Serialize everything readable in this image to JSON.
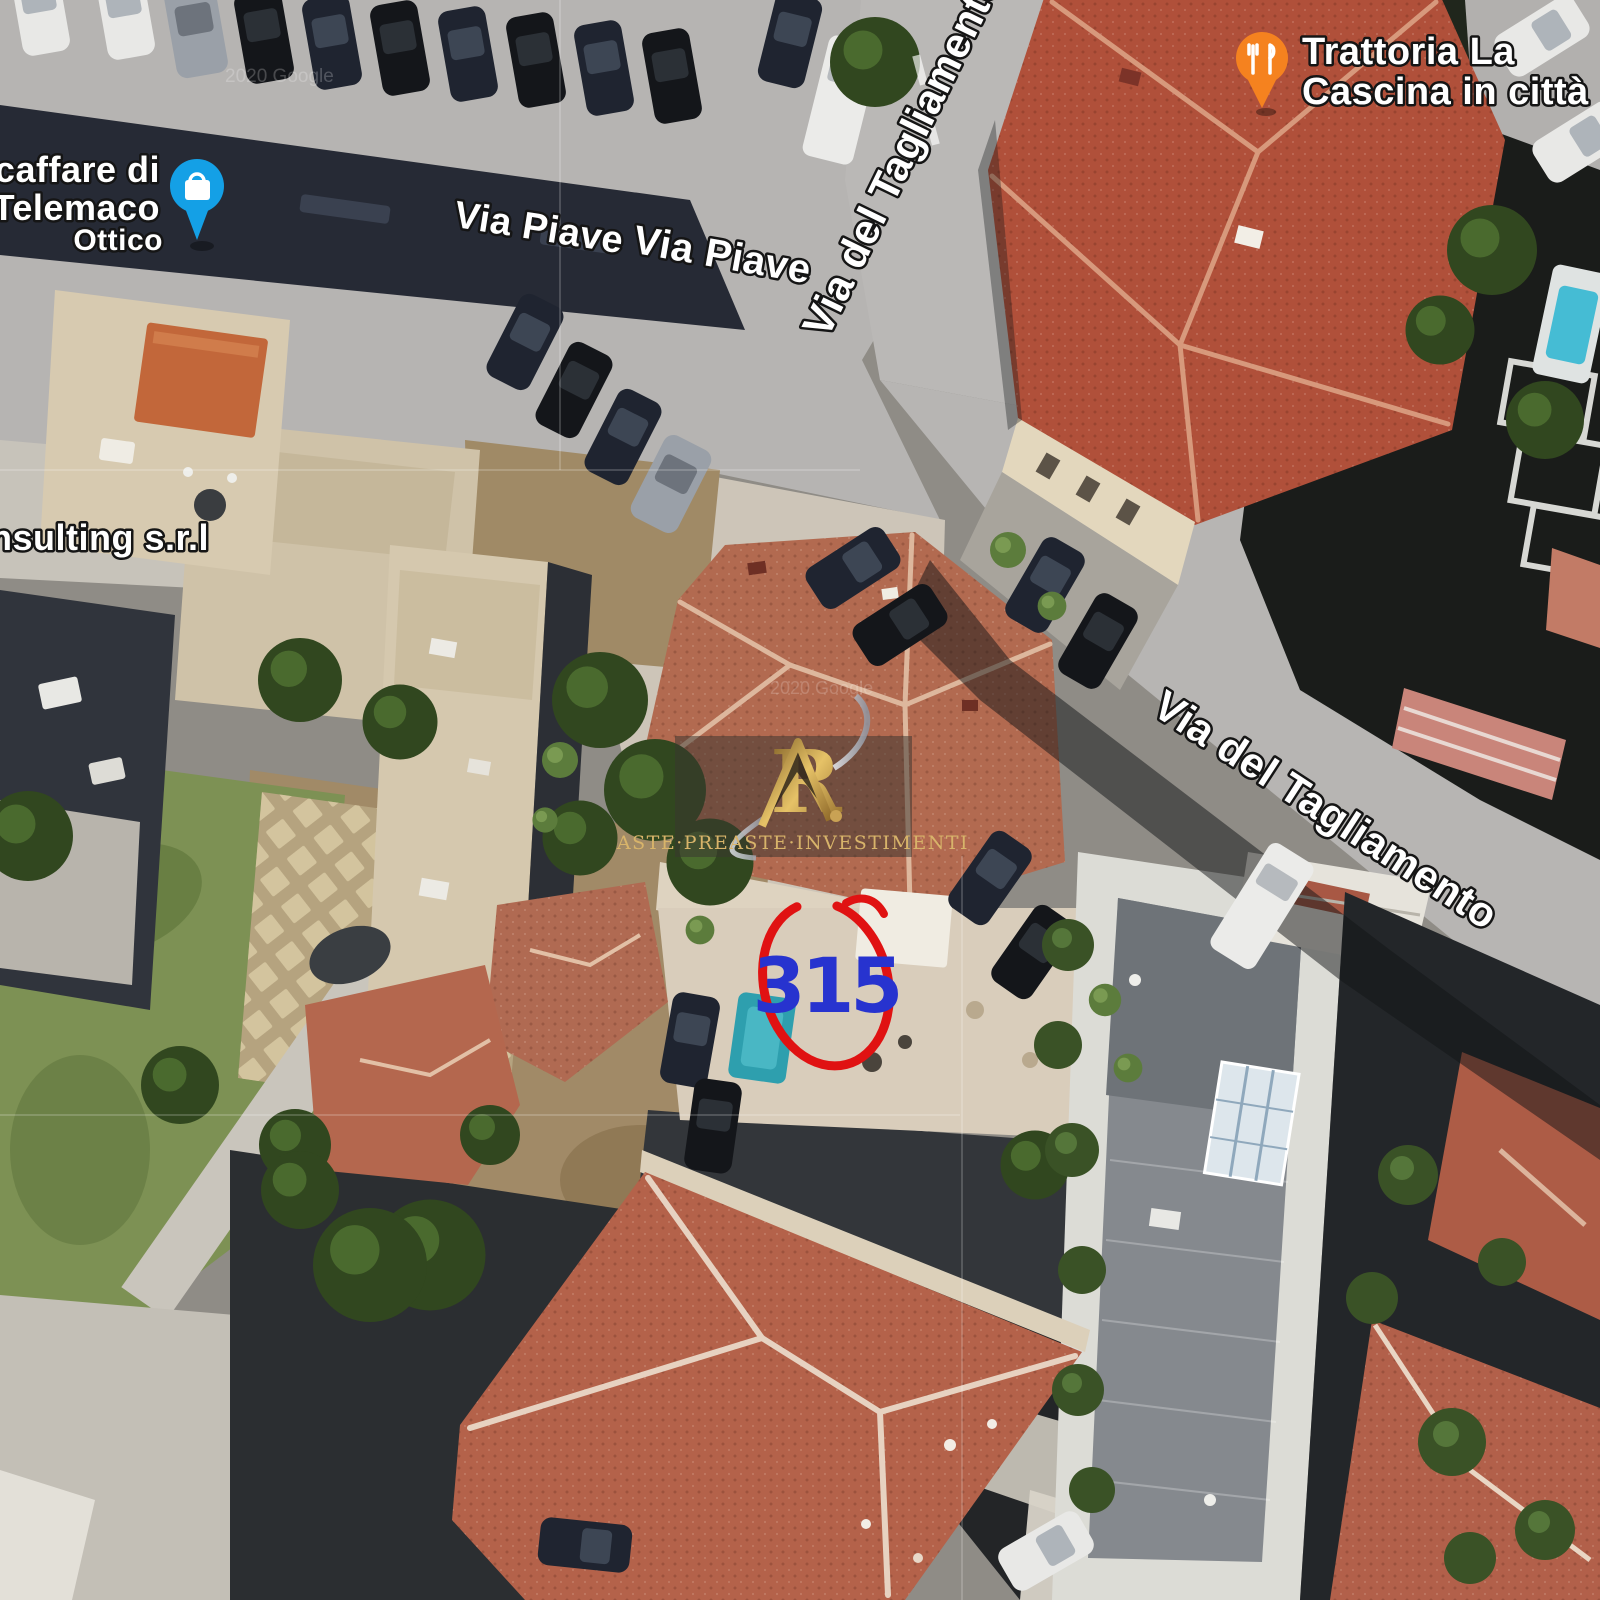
{
  "page": {
    "type": "satellite-map-screenshot",
    "description": "Aerial satellite view of an urban block with street labels, two business pins, an agency watermark and a red circled property number"
  },
  "street_labels": {
    "via_piave_a": "Via Piave",
    "via_piave_b": "Via Piave",
    "via_tagliamento_top": "Via del Tagliamento",
    "via_tagliamento_mid": "Via del Tagliamento"
  },
  "poi": {
    "ottica": {
      "line1": "Otticaffare di",
      "line2": "la Telemaco",
      "line3": "Ottico",
      "pin_color": "#14a0e6",
      "pin_icon": "shopping-bag"
    },
    "trattoria": {
      "line1": "Trattoria La",
      "line2": "Cascina in città",
      "pin_color": "#f5821f",
      "pin_icon": "fork-and-knife"
    },
    "consulting": {
      "label": "nsulting s.r.l"
    }
  },
  "property_marker": {
    "number": "315",
    "number_color": "#2733cf",
    "circle_color": "#e01212"
  },
  "watermark": {
    "monogram": "R",
    "brand": "ASTE·PREASTE·INVESTIMENTI",
    "gold": "#c9a254"
  },
  "imagery_credit": "2020 Google",
  "palette": {
    "asphalt": "#b6b4b2",
    "road": "#bab8b6",
    "concrete": "#cdc5b8",
    "roof_subject": "#b26a50",
    "roof_trattoria": "#b0503a",
    "roof_bottom": "#b4624a",
    "dark_roof": "#262a35",
    "shadow": "#1c1e20",
    "lawn": "#7d9154",
    "dirt": "#a08a66",
    "pool": "#2e9fae",
    "beige_terrace": "#d7cab0"
  }
}
